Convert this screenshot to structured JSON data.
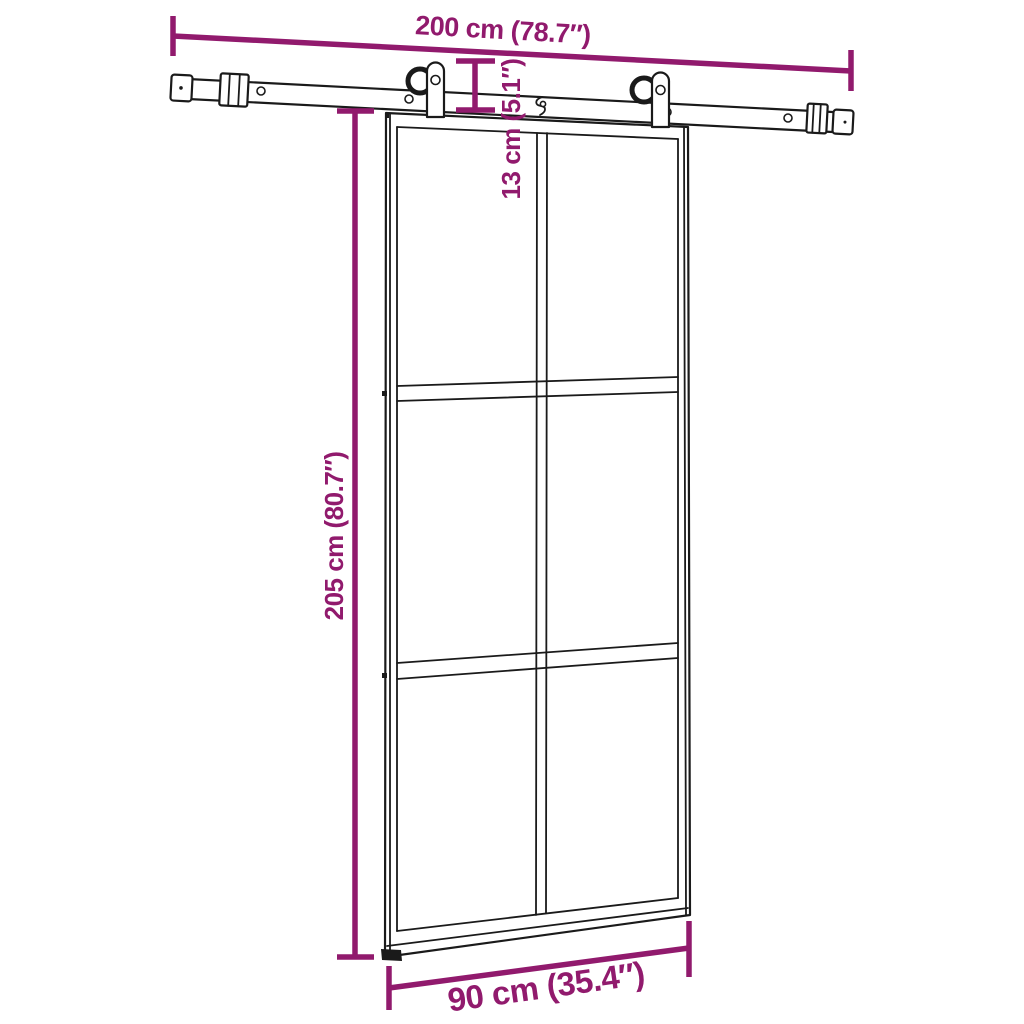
{
  "colors": {
    "dimension": "#911A6D",
    "line_art": "#1A1A1A",
    "background": "#FFFFFF"
  },
  "dimensions": {
    "rail_width": "200 cm (78.7″)",
    "hanger_height": "13 cm (5.1″)",
    "door_height": "205 cm (80.7″)",
    "door_width": "90 cm (35.4″)"
  }
}
